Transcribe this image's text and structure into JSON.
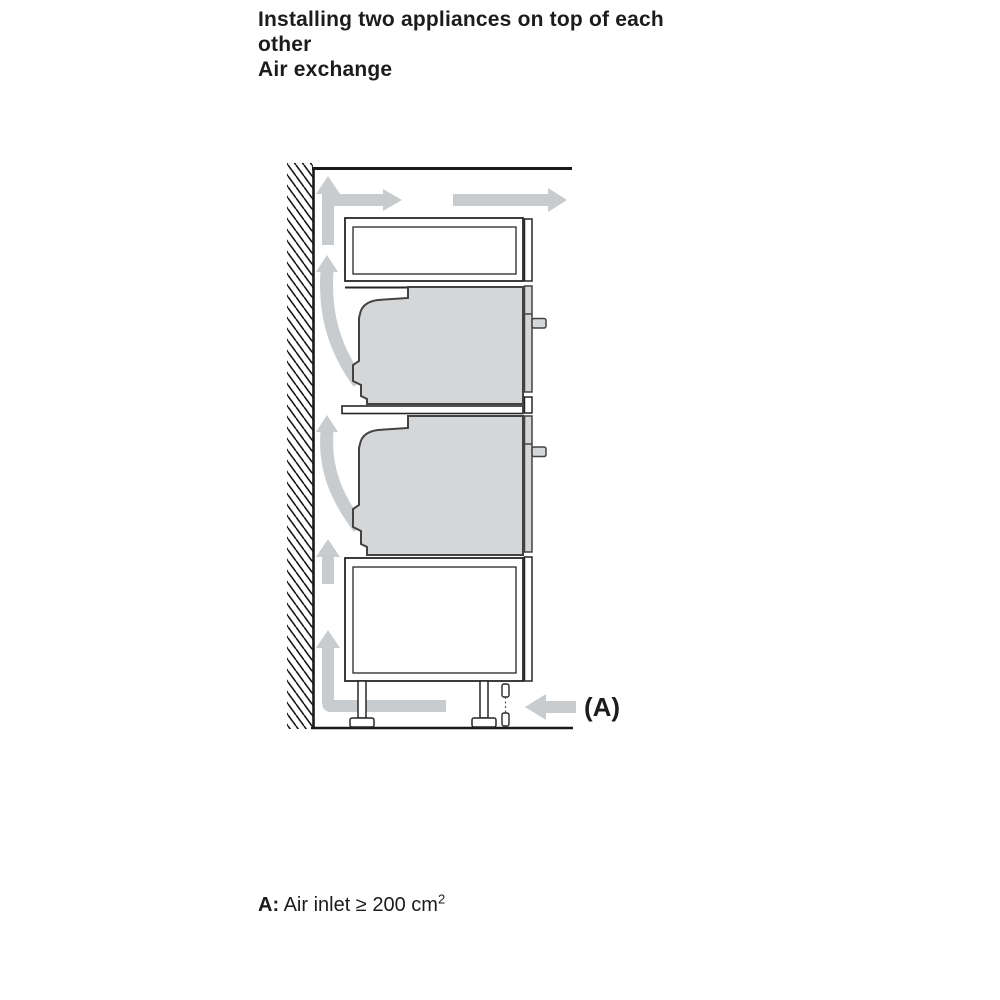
{
  "header": {
    "title": "Installing two appliances on top of each other",
    "subtitle": "Air exchange"
  },
  "diagram": {
    "label_a": "(A)",
    "colors": {
      "airflow_arrow": "#c9ccce",
      "appliance_fill": "#d4d6d8",
      "appliance_outline": "#424242",
      "cabinet_outline": "#262626",
      "wall_line": "#1a1a1a"
    },
    "icons": {
      "wall-hatch": "hatched wall cross-section",
      "airflow-up-arrow-top": "air rising above top compartment",
      "airflow-right-arrow-short": "air exhausting right at top",
      "airflow-right-arrow-long": "air exhausting right at top",
      "airflow-curved-arrow-upper": "air rising behind upper appliance",
      "airflow-curved-arrow-lower": "air rising behind lower appliance",
      "airflow-up-arrow-middle": "air rising behind base cabinet",
      "airflow-l-arrow-base": "air turning up from plinth",
      "air-inlet-arrow": "air entering at plinth inlet A"
    }
  },
  "caption": {
    "label": "A:",
    "text": " Air inlet ≥ 200 cm",
    "superscript": "2"
  }
}
